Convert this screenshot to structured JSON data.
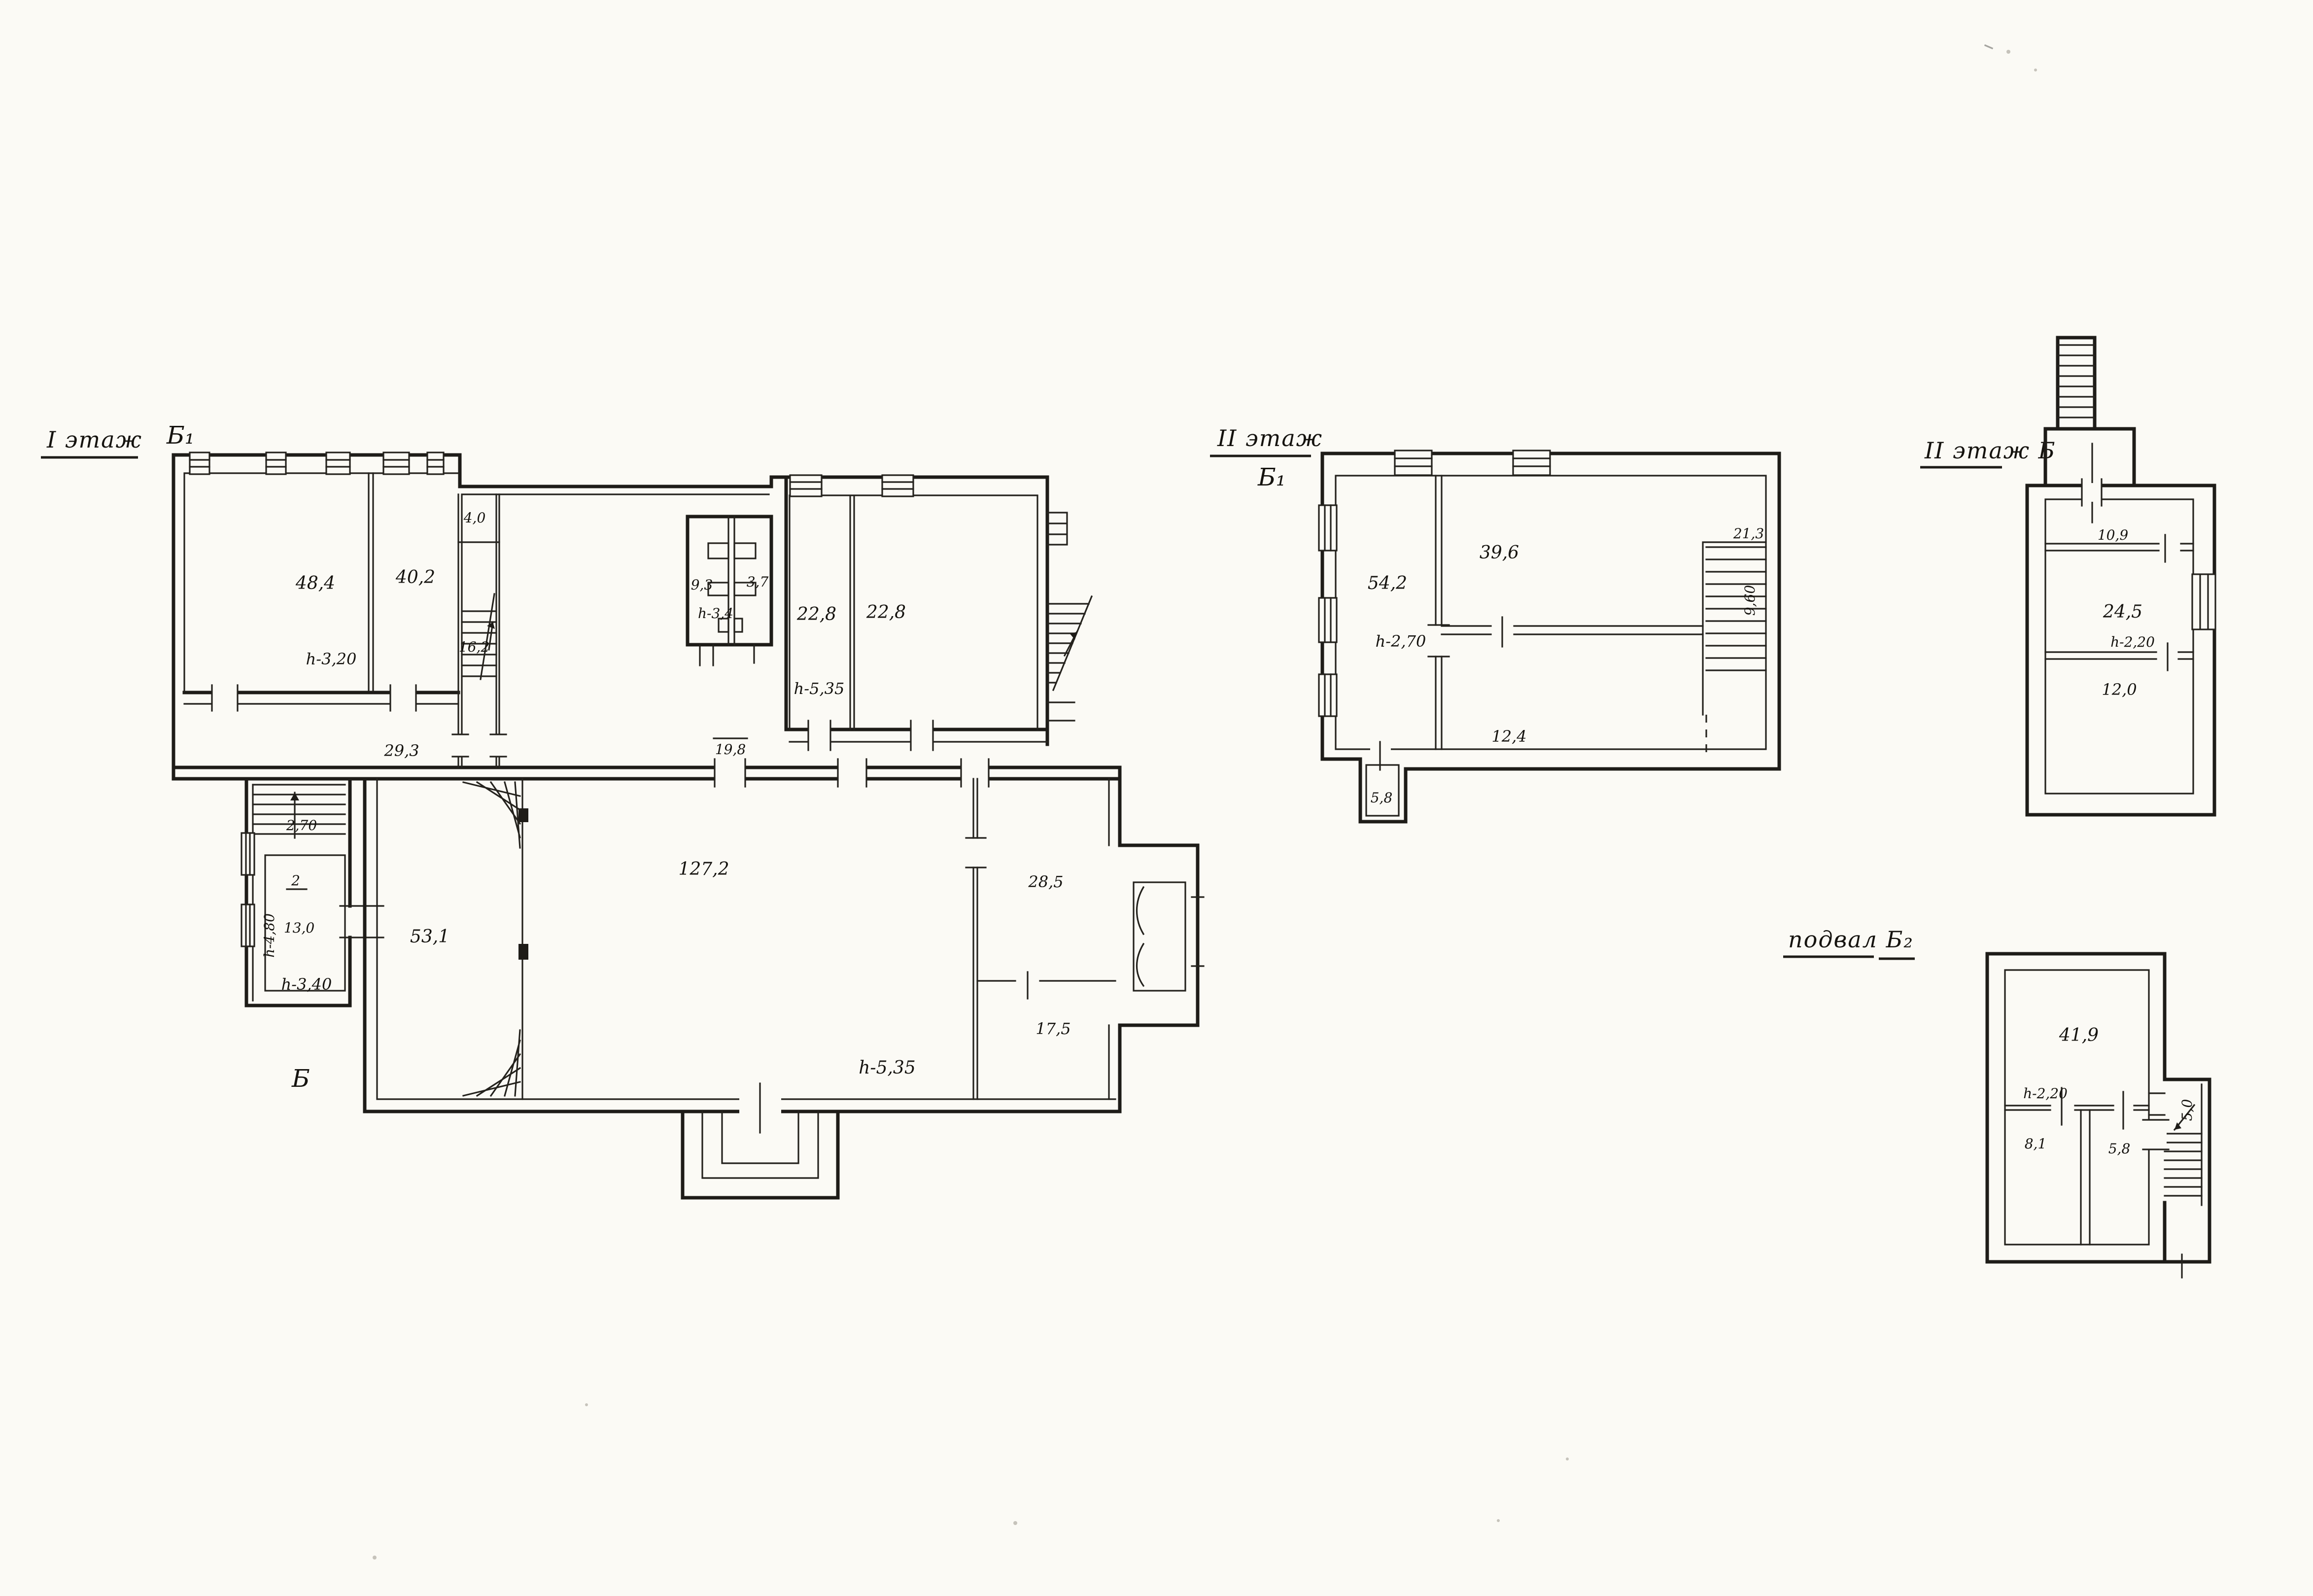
{
  "document": {
    "kind": "scanned hand-drawn building floor plans (BTI technical passport style)",
    "background_color": "#fbfaf5",
    "ink_color": "#1e1c18"
  },
  "plans": [
    {
      "title": "I этаж",
      "marker_top": "Б₁",
      "marker_bottom": "Б",
      "labels": {
        "a484": "48,4",
        "h320": "h-3,20",
        "a402": "40,2",
        "a40": "4,0",
        "a162": "16,2",
        "a93": "9,3",
        "a37": "3,7",
        "h34": "h-3,4",
        "a228a": "22,8",
        "a228b": "22,8",
        "h535a": "h-5,35",
        "a293": "29,3",
        "a198": "19,8",
        "st270": "2,70",
        "num2": "2",
        "a130": "13,0",
        "h340": "h-3,40",
        "h480": "h-4,80",
        "a531": "53,1",
        "a1272": "127,2",
        "h535b": "h-5,35",
        "a285": "28,5",
        "a175": "17,5"
      }
    },
    {
      "title": "II этаж",
      "marker": "Б₁",
      "labels": {
        "a542": "54,2",
        "h270": "h-2,70",
        "a396": "39,6",
        "a213": "21,3",
        "stair": "9,60",
        "a124": "12,4",
        "a58": "5,8"
      }
    },
    {
      "title": "II этаж Б",
      "labels": {
        "a109": "10,9",
        "a245": "24,5",
        "h220": "h-2,20",
        "a120": "12,0"
      }
    },
    {
      "title": "подвал Б₂",
      "labels": {
        "a419": "41,9",
        "h220": "h-2,20",
        "a81": "8,1",
        "a58": "5,8",
        "stair": "5,0"
      }
    }
  ]
}
